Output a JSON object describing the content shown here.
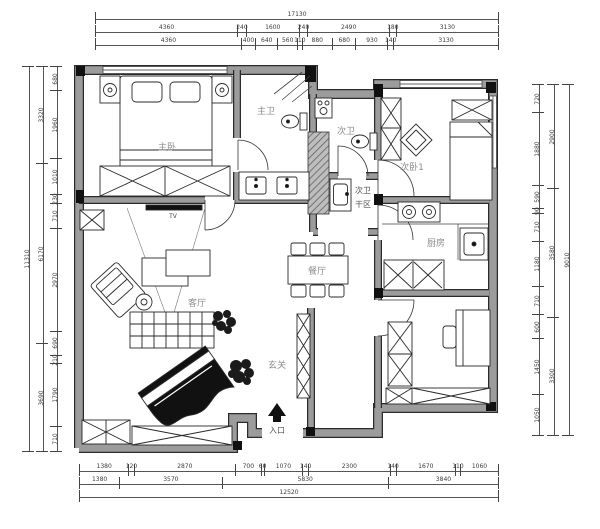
{
  "colors": {
    "wall_fill": "#9c9c9c",
    "wall_edge": "#2b2b2b",
    "line": "#222222",
    "room_label": "#8c8c8c",
    "dim_text": "#3c3c3c",
    "background": "#ffffff"
  },
  "rooms": {
    "master_bedroom": {
      "label": "主卧"
    },
    "master_bath": {
      "label": "主卫"
    },
    "second_bath": {
      "label": "次卫"
    },
    "dry_area": {
      "line1": "次卫",
      "line2": "干区"
    },
    "bedroom2": {
      "label": "次卧1"
    },
    "kitchen": {
      "label": "厨房"
    },
    "dining": {
      "label": "餐厅"
    },
    "living": {
      "label": "客厅"
    },
    "foyer": {
      "label": "玄关"
    },
    "entrance": {
      "label": "入口"
    },
    "tv": {
      "label": "TV"
    }
  },
  "dimensions": {
    "top": {
      "total": [
        "17130"
      ],
      "row2": [
        "4360",
        "240",
        "1600",
        "240",
        "2490",
        "180",
        "3130"
      ],
      "row3": [
        "4360",
        "400",
        "640",
        "560",
        "110",
        "880",
        "680",
        "930",
        "140",
        "3130"
      ]
    },
    "bottom": {
      "row1": [
        "1380",
        "120",
        "2870",
        "700",
        "60",
        "1070",
        "140",
        "2300",
        "140",
        "1670",
        "110",
        "1060"
      ],
      "row2": [
        "1380",
        "3570",
        "5830",
        "3840"
      ],
      "total": [
        "12520"
      ]
    },
    "left": {
      "inner": [
        "680",
        "1960",
        "1010",
        "230",
        "710",
        "2970",
        "690",
        "210",
        "1790",
        "710"
      ],
      "mid": [
        "3320",
        "6170",
        "3690"
      ],
      "total": [
        "11310"
      ]
    },
    "right": {
      "inner": [
        "720",
        "1880",
        "590",
        "90",
        "710",
        "1180",
        "710",
        "600",
        "1450",
        "1050"
      ],
      "mid": [
        "2900",
        "3580",
        "3300"
      ],
      "total": [
        "9010"
      ]
    }
  }
}
